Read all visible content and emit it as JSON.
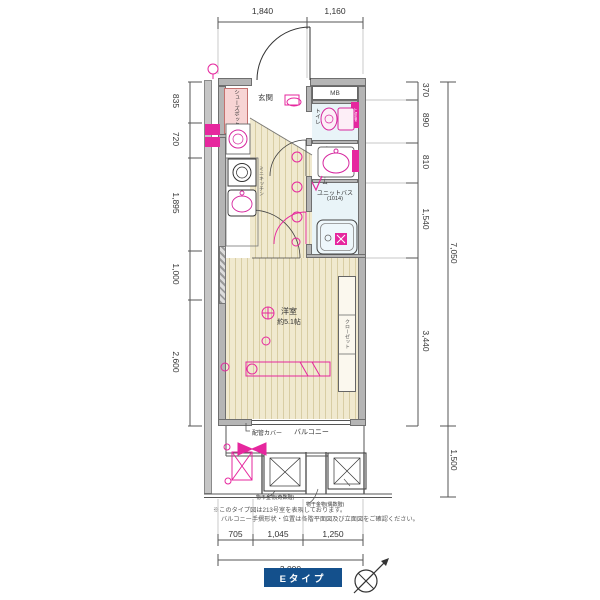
{
  "dims": {
    "top": [
      "1,840",
      "1,160"
    ],
    "left": [
      "835",
      "720",
      "1,895",
      "1,000",
      "2,600"
    ],
    "right": [
      "370",
      "890",
      "810",
      "1,540",
      "3,440"
    ],
    "right_total": "7,050",
    "balcony_depth": "1,500",
    "bottom": [
      "705",
      "1,045",
      "1,250"
    ],
    "bottom_total": "3,000"
  },
  "rooms": {
    "entrance": "玄関",
    "shoe_box": "シューズボックス",
    "meter_box": "MB",
    "toilet": "トイレ",
    "upper_shelf": "上部棚",
    "powder_room": "パウダールーム",
    "unit_bath": "ユニットバス",
    "unit_bath_size": "(1014)",
    "mini_kitchen": "ミニキッチン",
    "western_room": "洋室",
    "western_room_size": "約5.1帖",
    "closet": "クローゼット",
    "balcony": "バルコニー",
    "pipe_cover": "配管カバー"
  },
  "balcony_equipment": {
    "hatch": "避難ハッチ",
    "hatch_odd": "(奇数階)",
    "hatch_even": "(偶数階)",
    "second_floor_only": "2階のみ",
    "laundry_odd": "物干金物(奇数階)",
    "laundry_even": "物干金物(偶数階)"
  },
  "notes": {
    "line1": "※このタイプ図は213号室を表現しております。",
    "line2": "バルコニー手摺形状・位置は各階平面図及び立面図をご確認ください。"
  },
  "footer": {
    "type_label": "Eタイプ"
  },
  "colors": {
    "annotation": "#e6279e",
    "wall": "#b5b5b5",
    "water_floor": "#e9f4f8",
    "wood_floor": "#f0e9cf",
    "badge": "#14508c"
  }
}
